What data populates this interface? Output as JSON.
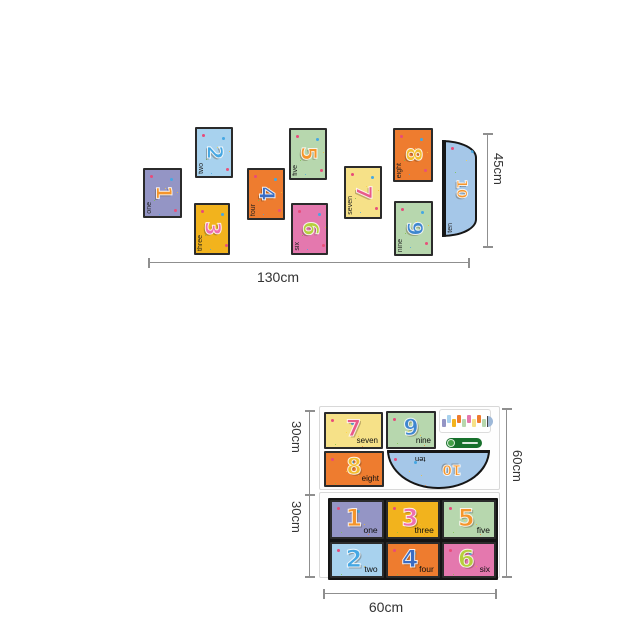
{
  "page": {
    "background": "#ffffff"
  },
  "dims": {
    "arrangement_width": "130cm",
    "arrangement_height": "45cm",
    "sheet_upper_height": "30cm",
    "sheet_lower_height": "30cm",
    "sheet_total_height": "60cm",
    "sheet_width": "60cm",
    "line_color": "#8f8f8f",
    "text_color": "#333333"
  },
  "arrangement": {
    "cards": [
      {
        "name": "one",
        "label": "one",
        "number": "1",
        "bg": "#9495c5",
        "num_color": "#f5952b",
        "x": 143,
        "y": 168,
        "w": 39,
        "h": 50
      },
      {
        "name": "two",
        "label": "two",
        "number": "2",
        "bg": "#a8d2ee",
        "num_color": "#45a7e3",
        "x": 195,
        "y": 127,
        "w": 38,
        "h": 51
      },
      {
        "name": "three",
        "label": "three",
        "number": "3",
        "bg": "#f2b31d",
        "num_color": "#ee6fae",
        "x": 194,
        "y": 203,
        "w": 36,
        "h": 52
      },
      {
        "name": "four",
        "label": "four",
        "number": "4",
        "bg": "#ee7c2f",
        "num_color": "#3a6cc3",
        "x": 247,
        "y": 168,
        "w": 38,
        "h": 52
      },
      {
        "name": "five",
        "label": "five",
        "number": "5",
        "bg": "#b7d7ae",
        "num_color": "#f5952b",
        "x": 289,
        "y": 128,
        "w": 38,
        "h": 52
      },
      {
        "name": "six",
        "label": "six",
        "number": "6",
        "bg": "#e478ae",
        "num_color": "#b6cf3d",
        "x": 291,
        "y": 203,
        "w": 37,
        "h": 52
      },
      {
        "name": "seven",
        "label": "seven",
        "number": "7",
        "bg": "#f6e188",
        "num_color": "#e85a88",
        "x": 344,
        "y": 166,
        "w": 38,
        "h": 53
      },
      {
        "name": "eight",
        "label": "eight",
        "number": "8",
        "bg": "#ee7c2f",
        "num_color": "#f3bd2e",
        "x": 393,
        "y": 128,
        "w": 40,
        "h": 54
      },
      {
        "name": "nine",
        "label": "nine",
        "number": "9",
        "bg": "#b7d7ae",
        "num_color": "#3e86cf",
        "x": 394,
        "y": 201,
        "w": 39,
        "h": 55
      }
    ],
    "ten": {
      "name": "ten",
      "label": "ten",
      "number": "10",
      "bg": "#a5c7e8",
      "num_color": "#f5952b",
      "x": 442,
      "y": 140,
      "w": 35,
      "h": 97
    }
  },
  "sheet_upper": {
    "cards": [
      {
        "name": "seven",
        "label": "seven",
        "number": "7",
        "bg": "#f6e188",
        "num_color": "#e85a88",
        "x": 4,
        "y": 5,
        "w": 59,
        "h": 37
      },
      {
        "name": "nine",
        "label": "nine",
        "number": "9",
        "bg": "#b7d7ae",
        "num_color": "#3e86cf",
        "x": 66,
        "y": 4,
        "w": 50,
        "h": 38
      },
      {
        "name": "eight",
        "label": "eight",
        "number": "8",
        "bg": "#ee7c2f",
        "num_color": "#f3bd2e",
        "x": 4,
        "y": 44,
        "w": 60,
        "h": 36
      }
    ],
    "ten": {
      "name": "ten",
      "label": "ten",
      "number": "10",
      "bg": "#a5c7e8",
      "num_color": "#f5952b",
      "x": 67,
      "y": 43,
      "w": 103,
      "h": 39
    },
    "thumbnail_colors": [
      "#9495c5",
      "#a8d2ee",
      "#f2b31d",
      "#ee7c2f",
      "#b7d7ae",
      "#e478ae",
      "#f6e188",
      "#ee7c2f",
      "#b7d7ae"
    ],
    "thumbnail_semicircle": "#9db8d8"
  },
  "sheet_lower": {
    "cards": [
      {
        "name": "one",
        "label": "one",
        "number": "1",
        "bg": "#9495c5",
        "num_color": "#f5952b"
      },
      {
        "name": "three",
        "label": "three",
        "number": "3",
        "bg": "#f2b31d",
        "num_color": "#ee6fae"
      },
      {
        "name": "five",
        "label": "five",
        "number": "5",
        "bg": "#b7d7ae",
        "num_color": "#f5952b"
      },
      {
        "name": "two",
        "label": "two",
        "number": "2",
        "bg": "#a8d2ee",
        "num_color": "#45a7e3"
      },
      {
        "name": "four",
        "label": "four",
        "number": "4",
        "bg": "#ee7c2f",
        "num_color": "#3a6cc3"
      },
      {
        "name": "six",
        "label": "six",
        "number": "6",
        "bg": "#e478ae",
        "num_color": "#b6cf3d"
      }
    ]
  }
}
